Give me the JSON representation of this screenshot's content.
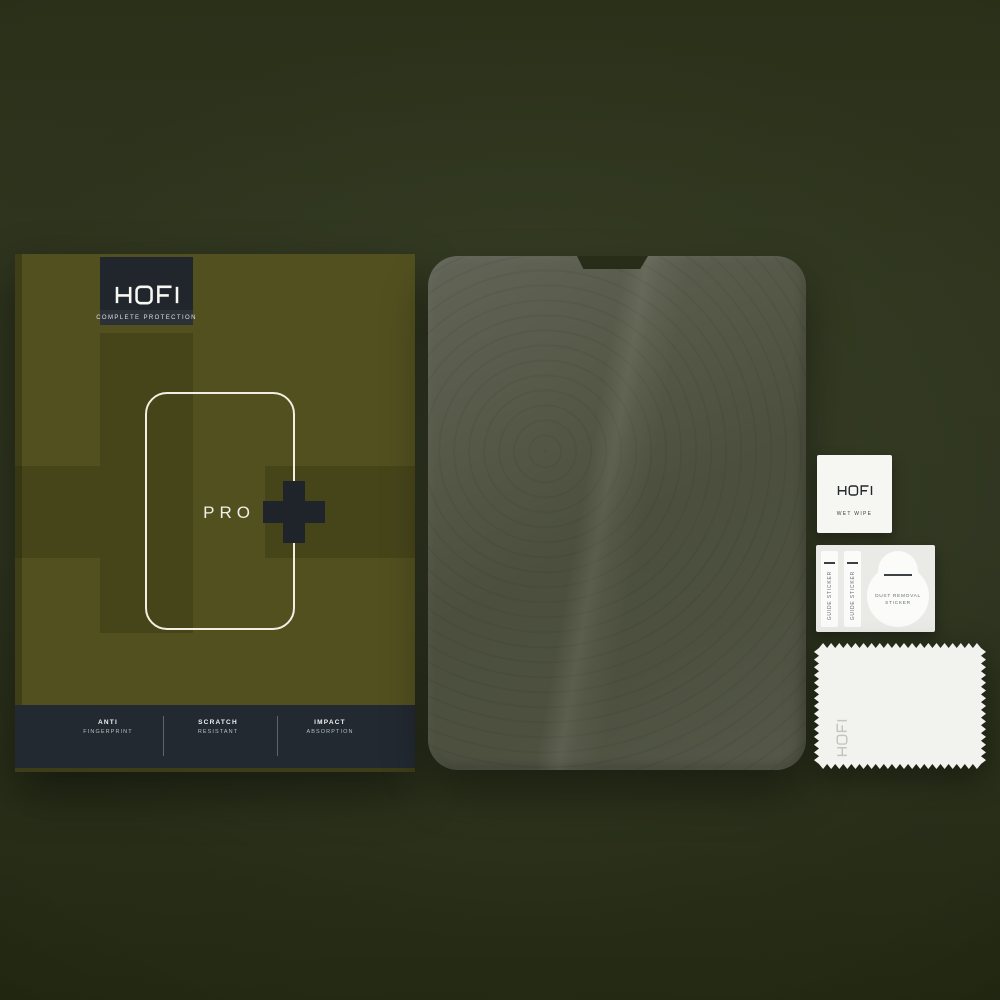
{
  "brand": "HOFI",
  "box": {
    "logo": {
      "text": "HOFI",
      "subtitle": "COMPLETE PROTECTION"
    },
    "product_line": {
      "name": "PRO",
      "symbol": "+"
    },
    "features": [
      {
        "title": "ANTI",
        "subtitle": "FINGERPRINT"
      },
      {
        "title": "SCRATCH",
        "subtitle": "RESISTANT"
      },
      {
        "title": "IMPACT",
        "subtitle": "ABSORPTION"
      }
    ]
  },
  "accessories": {
    "wet_wipe": {
      "brand": "HOFI",
      "label": "WET WIPE"
    },
    "guide_sticker_left": {
      "label": "GUIDE STICKER"
    },
    "guide_sticker_right": {
      "label": "GUIDE STICKER"
    },
    "dust_removal_sticker": {
      "label_line1": "DUST REMOVAL",
      "label_line2": "STICKER"
    },
    "cloth": {
      "brand": "HOFI"
    }
  },
  "colors": {
    "background_olive": "#2f3520",
    "box_olive": "#52501f",
    "box_pattern_dark": "#46451a",
    "panel_dark_slate": "#232931",
    "accent_white": "#f2efe2",
    "film_gray_green": "#4e513f",
    "plus_dark": "#1e242a"
  }
}
